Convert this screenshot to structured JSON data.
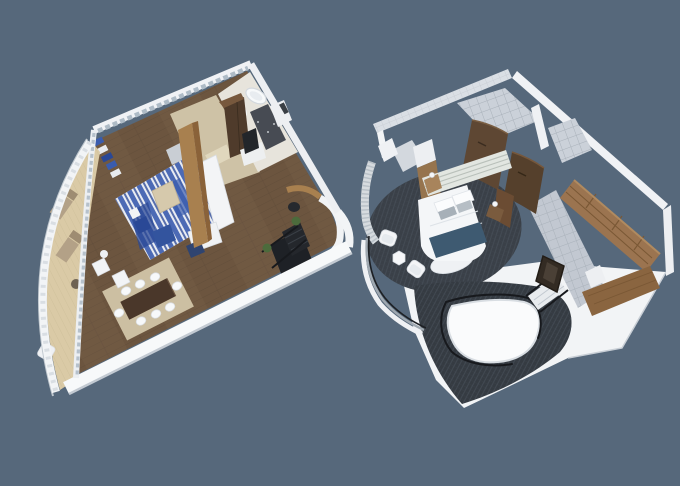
{
  "scene": {
    "type": "3d-floorplan-render",
    "plan_count": 2,
    "plans": [
      {
        "id": "left-suite-floorplan",
        "rooms": [
          "balcony-deck",
          "living-room",
          "dining-area",
          "entry-hall",
          "bathroom",
          "media-wall",
          "staircase"
        ]
      },
      {
        "id": "right-suite-floorplan",
        "rooms": [
          "round-bedroom",
          "bathroom",
          "walk-in-closet",
          "stair-void",
          "curved-terrace"
        ]
      }
    ]
  },
  "colors": {
    "background": "#56687B",
    "wall-white": "#F2F4F6",
    "wall-bright": "#F7F9FA",
    "wall-shadow": "#C3CAD2",
    "window-pane": "#AEBBC6",
    "tile-wall": "#DADFE5",
    "tile-wall-line": "#C6CBD2",
    "tile-floor": "#C2C8D1",
    "tile-floor-line": "#A9B1BA",
    "bath-tile": "#CBD1D9",
    "carpet-dark": "#3A4048",
    "carpet-weave": "#4A525C",
    "wood-floor": "#6C553F",
    "plank-seam": "#5C4836",
    "deck": "#DACAA6",
    "deck-seam": "#CBBC97",
    "entry-beige": "#CEC2A6",
    "entry-rug": "#E0D7BD",
    "rug-white": "#E9ECF2",
    "rug-blue": "#3A5CAE",
    "rug-blue-deep": "#2A4896",
    "dining-rug": "#CCBFA2",
    "table-wood": "#4A372A",
    "sofa-white": "#F3F4F6",
    "coffee-table": "#D6C9AC",
    "ottoman-blue": "#33549E",
    "navy-throw": "#3E5A71",
    "headboard-panel": "#E2E6E1",
    "headboard-line": "#B9C0BA",
    "wood-mid": "#A8804F",
    "wood-partition-side": "#8A6239",
    "wood-door": "#5E4733",
    "wood-door-dark": "#55402C",
    "wardrobe-front": "#4F3B2B",
    "wardrobe-top": "#77583D",
    "closet-wood": "#9B7450",
    "closet-wood-dark": "#8A6540",
    "closet-shelf-line": "#7A5835",
    "lounger-tan": "#B3A187",
    "lounger-tan-dark": "#9E8C72",
    "plant-green": "#4C6B3C",
    "stair-black": "#1E2126",
    "rail-black": "#17191D",
    "mirror-dark": "#332B23",
    "curtain": "#D6DBDF",
    "curtain-fold": "#B9C1C8",
    "chair-gray": "#C9CED4",
    "dark-tile": "#474B53"
  }
}
